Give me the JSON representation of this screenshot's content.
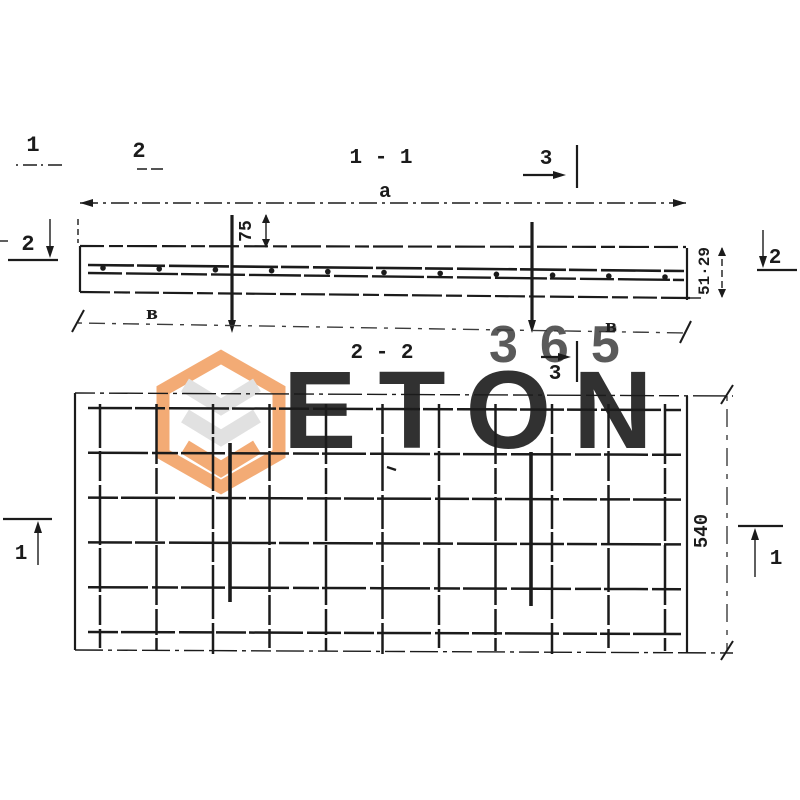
{
  "titles": {
    "section1": "1 - 1",
    "section2": "2 - 2"
  },
  "labels": {
    "pos1": "1",
    "pos2": "2",
    "cut1": "1",
    "cut2": "2",
    "cut3": "3",
    "dim_a": "a",
    "dim_pin_height": "75",
    "dim_thickness": "51·29",
    "dim_width": "540",
    "edge_left": "в",
    "edge_right": "в"
  },
  "mesh": {
    "vertical_bars": 11,
    "horizontal_bars": 6,
    "section_dots": 11,
    "pins": 2
  },
  "watermark": {
    "brand": "ETON",
    "number": "365",
    "orange": "#f2a267",
    "gray": "#dedede"
  },
  "ink_color": "#1b1b1b"
}
